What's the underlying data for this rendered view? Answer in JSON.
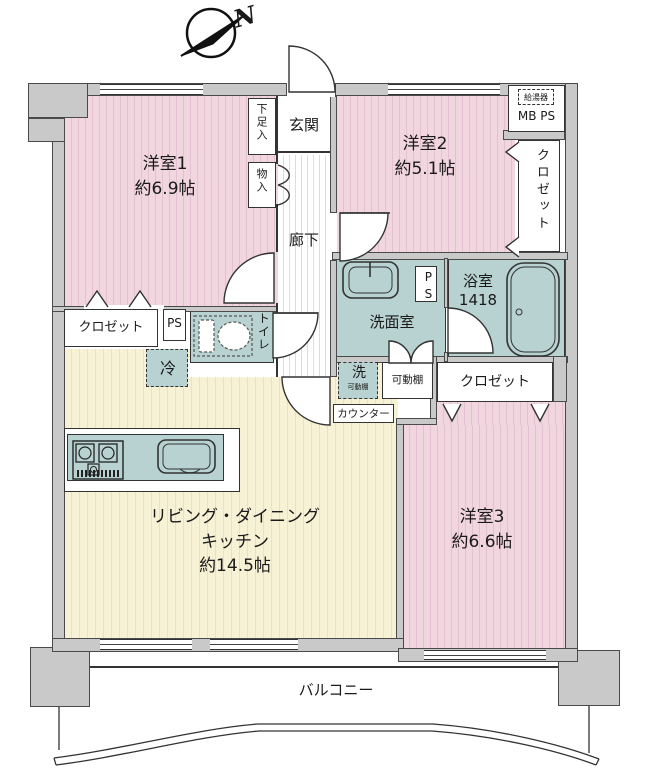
{
  "compass": {
    "label": "N"
  },
  "rooms": {
    "bedroom1": {
      "name": "洋室1",
      "size": "約6.9帖"
    },
    "bedroom2": {
      "name": "洋室2",
      "size": "約5.1帖"
    },
    "bedroom3": {
      "name": "洋室3",
      "size": "約6.6帖"
    },
    "ldk": {
      "name_line1": "リビング・ダイニング",
      "name_line2": "キッチン",
      "size": "約14.5帖"
    },
    "entrance": {
      "name": "玄関"
    },
    "corridor": {
      "name": "廊下"
    },
    "toilet": {
      "name": "トイレ"
    },
    "washroom": {
      "name": "洗面室"
    },
    "bathroom": {
      "name": "浴室",
      "size": "1418"
    },
    "balcony": {
      "name": "バルコニー"
    }
  },
  "storage": {
    "shoe_cabinet": "下足入",
    "hall_closet": "物入",
    "closet_bedroom1": "クロゼット",
    "closet_bedroom2": "クロゼット",
    "closet_bedroom3": "クロゼット",
    "movable_shelf": "可動棚",
    "counter": "カウンター"
  },
  "equipment": {
    "pipe_space_1": "PS",
    "pipe_space_2": "PS",
    "meter_box": "MB PS",
    "water_heater": "給湯器",
    "refrigerator": "冷",
    "washer": "洗",
    "washer_note": "可動棚"
  },
  "colors": {
    "room_pink": "#f1d6df",
    "ldk_cream": "#f7f1d5",
    "wet_teal": "#b7d2d0",
    "wall_gray": "#c9c9c9"
  }
}
